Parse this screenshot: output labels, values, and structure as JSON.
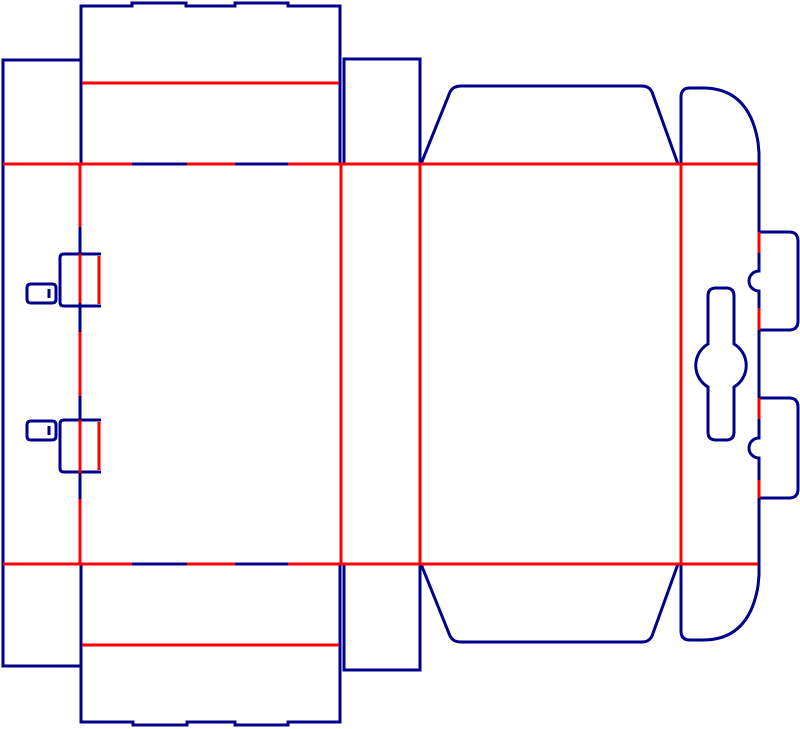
{
  "document": {
    "type": "packaging-dieline-diagram",
    "background": "#ffffff"
  },
  "colors": {
    "cut": "#00008B",
    "crease": "#FF0000"
  },
  "stroke": {
    "width": 3
  },
  "parts": [
    "left-lock-panel",
    "front-panel",
    "side-panel",
    "back-panel",
    "tuck-lock-panel",
    "top-tuck-flap",
    "bottom-tuck-flap",
    "top-side-dust-flap",
    "bottom-side-dust-flap",
    "top-back-dust-flap",
    "bottom-back-dust-flap",
    "top-curved-flap",
    "bottom-curved-flap",
    "right-lock-tab-1",
    "right-lock-tab-2",
    "left-lock-tab-1",
    "left-lock-tab-2",
    "left-slot-1",
    "left-slot-2",
    "keyhole-cutout"
  ]
}
